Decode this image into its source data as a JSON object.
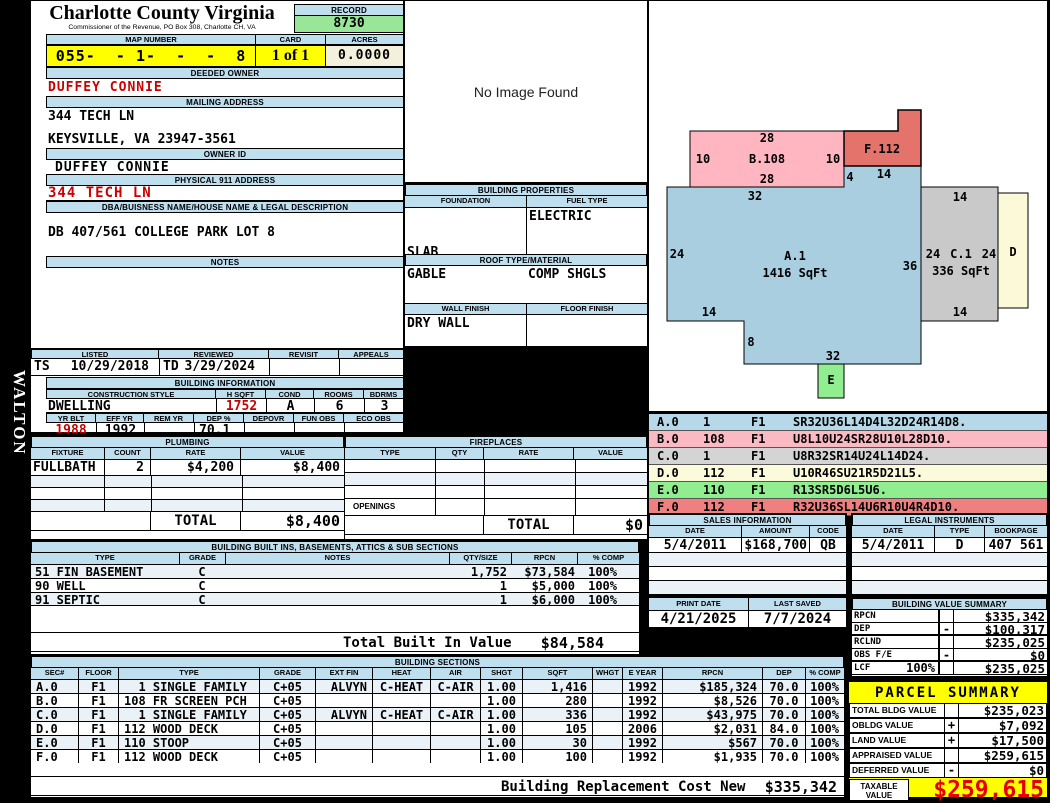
{
  "sidebar": {
    "vertical_text": "WALTON"
  },
  "header": {
    "county": "Charlotte County Virginia",
    "subtitle": "Commissioner of the Revenue, PO Box 308, Charlotte CH, VA",
    "record_label": "RECORD",
    "record_value": "8730",
    "map_label": "MAP NUMBER",
    "map_value": "055-  - 1-  -  -  8",
    "card_label": "CARD",
    "card_value": "1 of 1",
    "acres_label": "ACRES",
    "acres_value": "0.0000"
  },
  "owner": {
    "deeded_label": "DEEDED OWNER",
    "deeded_value": "DUFFEY CONNIE",
    "mailing_label": "MAILING ADDRESS",
    "mailing_line1": "344 TECH LN",
    "mailing_line2": "KEYSVILLE, VA 23947-3561",
    "owner_id_label": "OWNER ID",
    "owner_id_value": "DUFFEY CONNIE",
    "physical_label": "PHYSICAL 911 ADDRESS",
    "physical_value": "344 TECH LN",
    "legal_label": "DBA/BUISNESS NAME/HOUSE NAME & LEGAL DESCRIPTION",
    "legal_value": "DB 407/561 COLLEGE PARK LOT 8",
    "notes_label": "NOTES",
    "notes_value": ""
  },
  "review": {
    "listed_label": "LISTED",
    "reviewed_label": "REVIEWED",
    "revisit_label": "REVISIT",
    "appeals_label": "APPEALS",
    "listed_by": "TS",
    "listed_date": "10/29/2018",
    "reviewed_by": "TD",
    "reviewed_date": "3/29/2024",
    "revisit_value": "",
    "appeals_value": ""
  },
  "building_info": {
    "label": "BUILDING INFORMATION",
    "style_label": "CONSTRUCTION STYLE",
    "hsqft_label": "H SQFT",
    "cond_label": "COND",
    "rooms_label": "ROOMS",
    "bdrms_label": "BDRMS",
    "style": "DWELLING",
    "hsqft": "1752",
    "cond": "A",
    "rooms": "6",
    "bdrms": "3",
    "yrblt_label": "YR BLT",
    "effyr_label": "EFF YR",
    "remyr_label": "REM YR",
    "dep_label": "DEP %",
    "depovr_label": "DEPOVR",
    "funobs_label": "FUN OBS",
    "ecoobs_label": "ECO OBS",
    "yrblt": "1988",
    "effyr": "1992",
    "remyr": "",
    "dep": "70.1",
    "depovr": "",
    "funobs": "",
    "ecoobs": ""
  },
  "plumbing": {
    "label": "PLUMBING",
    "fixture_label": "FIXTURE",
    "count_label": "COUNT",
    "rate_label": "RATE",
    "value_label": "VALUE",
    "fixture": "FULLBATH",
    "count": "2",
    "rate": "$4,200",
    "value": "$8,400",
    "total_label": "TOTAL",
    "total": "$8,400"
  },
  "fireplaces": {
    "label": "FIREPLACES",
    "type_label": "TYPE",
    "qty_label": "QTY",
    "rate_label": "RATE",
    "value_label": "VALUE",
    "openings_label": "OPENINGS",
    "total_label": "TOTAL",
    "total": "$0"
  },
  "photo": {
    "message": "No Image Found"
  },
  "properties": {
    "label": "BUILDING PROPERTIES",
    "foundation_label": "FOUNDATION",
    "fuel_label": "FUEL TYPE",
    "foundation1": "SLAB",
    "foundation2": "BRICK & BLOCK",
    "fuel": "ELECTRIC",
    "roof_label": "ROOF TYPE/MATERIAL",
    "roof_type": "GABLE",
    "roof_material": "COMP SHGLS",
    "wall_label": "WALL FINISH",
    "floor_label": "FLOOR FINISH",
    "wall": "DRY WALL",
    "floor1": "CARPET",
    "floor2": "VINYL"
  },
  "built_ins": {
    "label": "BUILDING BUILT INS, BASEMENTS, ATTICS & SUB SECTIONS",
    "type_label": "TYPE",
    "grade_label": "GRADE",
    "notes_label": "NOTES",
    "qty_label": "QTY/SIZE",
    "rpcn_label": "RPCN",
    "comp_label": "% COMP",
    "rows": [
      {
        "type": "51 FIN BASEMENT",
        "grade": "C",
        "notes": "",
        "qty": "1,752",
        "rpcn": "$73,584",
        "comp": "100%"
      },
      {
        "type": "90 WELL",
        "grade": "C",
        "notes": "",
        "qty": "1",
        "rpcn": "$5,000",
        "comp": "100%"
      },
      {
        "type": "91 SEPTIC",
        "grade": "C",
        "notes": "",
        "qty": "1",
        "rpcn": "$6,000",
        "comp": "100%"
      }
    ],
    "total_label": "Total Built In Value",
    "total": "$84,584"
  },
  "sections": {
    "label": "BUILDING SECTIONS",
    "headers": [
      "SEC#",
      "FLOOR",
      "TYPE",
      "GRADE",
      "EXT FIN",
      "HEAT",
      "AIR",
      "SHGT",
      "SQFT",
      "WHGT",
      "E YEAR",
      "RPCN",
      "DEP",
      "% COMP"
    ],
    "rows": [
      {
        "sec": "A.0",
        "floor": "F1",
        "type": "  1 SINGLE FAMILY",
        "grade": "C+05",
        "ext": "ALVYN",
        "heat": "C-HEAT",
        "air": "C-AIR",
        "shgt": "1.00",
        "sqft": "1,416",
        "whgt": "",
        "eyear": "1992",
        "rpcn": "$185,324",
        "dep": "70.0",
        "comp": "100%"
      },
      {
        "sec": "B.0",
        "floor": "F1",
        "type": "108 FR SCREEN PCH",
        "grade": "C+05",
        "ext": "",
        "heat": "",
        "air": "",
        "shgt": "1.00",
        "sqft": "280",
        "whgt": "",
        "eyear": "1992",
        "rpcn": "$8,526",
        "dep": "70.0",
        "comp": "100%"
      },
      {
        "sec": "C.0",
        "floor": "F1",
        "type": "  1 SINGLE FAMILY",
        "grade": "C+05",
        "ext": "ALVYN",
        "heat": "C-HEAT",
        "air": "C-AIR",
        "shgt": "1.00",
        "sqft": "336",
        "whgt": "",
        "eyear": "1992",
        "rpcn": "$43,975",
        "dep": "70.0",
        "comp": "100%"
      },
      {
        "sec": "D.0",
        "floor": "F1",
        "type": "112 WOOD DECK",
        "grade": "C+05",
        "ext": "",
        "heat": "",
        "air": "",
        "shgt": "1.00",
        "sqft": "105",
        "whgt": "",
        "eyear": "2006",
        "rpcn": "$2,031",
        "dep": "84.0",
        "comp": "100%"
      },
      {
        "sec": "E.0",
        "floor": "F1",
        "type": "110 STOOP",
        "grade": "C+05",
        "ext": "",
        "heat": "",
        "air": "",
        "shgt": "1.00",
        "sqft": "30",
        "whgt": "",
        "eyear": "1992",
        "rpcn": "$567",
        "dep": "70.0",
        "comp": "100%"
      },
      {
        "sec": "F.0",
        "floor": "F1",
        "type": "112 WOOD DECK",
        "grade": "C+05",
        "ext": "",
        "heat": "",
        "air": "",
        "shgt": "1.00",
        "sqft": "100",
        "whgt": "",
        "eyear": "1992",
        "rpcn": "$1,935",
        "dep": "70.0",
        "comp": "100%"
      }
    ],
    "footer_label": "Building Replacement Cost New",
    "footer_value": "$335,342"
  },
  "sketch": {
    "a_label": "A.1",
    "a_sqft": "1416 SqFt",
    "a_top32": "32",
    "a_seg4": "4",
    "a_top14": "14",
    "a_left24": "24",
    "a_right36": "36",
    "a_bl14": "14",
    "a_step8": "8",
    "a_bottom32": "32",
    "b_label": "B.108",
    "b_top": "28",
    "b_left": "10",
    "b_right": "10",
    "b_bottom": "28",
    "f_label": "F.112",
    "c_label": "C.1",
    "c_sqft": "336 SqFt",
    "c_top": "14",
    "c_left": "24",
    "c_right": "24",
    "c_bottom": "14",
    "d_label": "D",
    "e_label": "E"
  },
  "vectors": [
    {
      "sec": "A.0",
      "code": "1",
      "floor": "F1",
      "path": "SR32U36L14D4L32D24R14D8."
    },
    {
      "sec": "B.0",
      "code": "108",
      "floor": "F1",
      "path": "U8L10U24SR28U10L28D10."
    },
    {
      "sec": "C.0",
      "code": "1",
      "floor": "F1",
      "path": "U8R32SR14U24L14D24."
    },
    {
      "sec": "D.0",
      "code": "112",
      "floor": "F1",
      "path": "U10R46SU21R5D21L5."
    },
    {
      "sec": "E.0",
      "code": "110",
      "floor": "F1",
      "path": "R13SR5D6L5U6."
    },
    {
      "sec": "F.0",
      "code": "112",
      "floor": "F1",
      "path": "R32U36SL14U6R10U4R4D10."
    }
  ],
  "sales": {
    "label": "SALES INFORMATION",
    "date_label": "DATE",
    "amount_label": "AMOUNT",
    "code_label": "CODE",
    "date": "5/4/2011",
    "amount": "$168,700",
    "code": "QB"
  },
  "legal": {
    "label": "LEGAL INSTRUMENTS",
    "date_label": "DATE",
    "type_label": "TYPE",
    "book_label": "BOOKPAGE",
    "date": "5/4/2011",
    "type": "D",
    "book": "407 561"
  },
  "meta": {
    "print_label": "PRINT DATE",
    "print_date": "4/21/2025",
    "saved_label": "LAST SAVED",
    "saved_date": "7/7/2024"
  },
  "value_summary": {
    "label": "BUILDING VALUE SUMMARY",
    "rows": [
      {
        "label": "RPCN",
        "pct": "",
        "op": "",
        "value": "$335,342"
      },
      {
        "label": "DEP",
        "pct": "",
        "op": "-",
        "value": "$100,317"
      },
      {
        "label": "RCLND",
        "pct": "",
        "op": "",
        "value": "$235,025"
      },
      {
        "label": "OBS F/E",
        "pct": "",
        "op": "-",
        "value": "$0"
      },
      {
        "label": "LCF",
        "pct": "100%",
        "op": "",
        "value": "$235,025"
      }
    ]
  },
  "parcel": {
    "label": "PARCEL SUMMARY",
    "rows": [
      {
        "label": "TOTAL BLDG VALUE",
        "op": "",
        "value": "$235,023"
      },
      {
        "label": "OBLDG VALUE",
        "op": "+",
        "value": "$7,092"
      },
      {
        "label": "LAND VALUE",
        "op": "+",
        "value": "$17,500"
      },
      {
        "label": "APPRAISED VALUE",
        "op": "",
        "value": "$259,615"
      },
      {
        "label": "DEFERRED VALUE",
        "op": "-",
        "value": "$0"
      }
    ],
    "taxable_label_1": "TAXABLE",
    "taxable_label_2": "VALUE",
    "taxable_value": "$259,615"
  },
  "colors": {
    "header_blue": "#BFDEEE",
    "highlight_yellow": "#FFFF00",
    "record_green": "#99E699",
    "acres_cream": "#F3F0DC",
    "value_red_text": "#CC0000",
    "taxable_red_text": "#E60000",
    "sketch_a_blue": "#A8CEE0",
    "sketch_b_pink": "#FFB6C1",
    "sketch_f_red": "#E4736B",
    "sketch_c_gray": "#C9C9C9",
    "sketch_d_cream": "#FBF9D8",
    "sketch_e_green": "#90EE90"
  }
}
